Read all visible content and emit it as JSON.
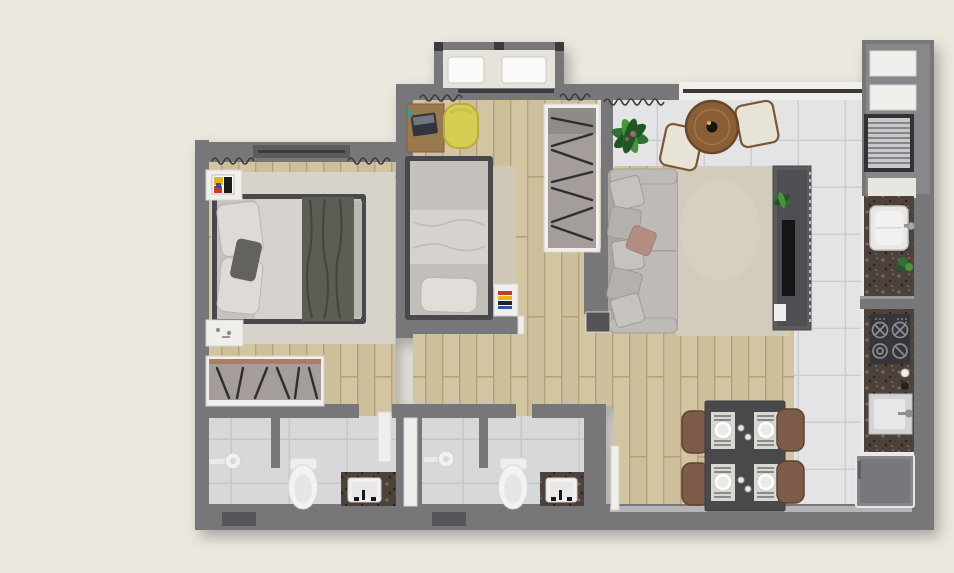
{
  "headline": {
    "lines": [
      "APARTAMENTOS",
      "PROJETADOS COM",
      "O PADRÃO DE",
      "QUALIDADE GIROLLAR."
    ]
  },
  "palette": {
    "background": "#ebe8df",
    "headline": "#3d4348",
    "wall": "#77777a",
    "wall_light": "#8e8e91",
    "wall_dark": "#3a3a3d",
    "wood": "#d3c4a2",
    "wood_dark": "#b3a179",
    "tile": "#e4e4e6",
    "tile_line": "#cdcdd0",
    "bath_tile": "#d8d8da",
    "bath_tile_line": "#c6c6c9",
    "granite": "#4d423a",
    "granite_fleck_light": "#7a6c5f",
    "granite_fleck_dark": "#29221c",
    "white_fixture": "#f3f2f0",
    "fixture_shadow": "#d6d5d3",
    "sofa": "#a9a6a3",
    "sofa_light": "#bdbab7",
    "cushion": "#c6c3bf",
    "cushion_rose": "#b18d82",
    "rug_living": "#d3cbbb",
    "rug_bedroom": "#d7d2ca",
    "bed_frame": "#4a4a4d",
    "bed_linen": "#c5c2be",
    "bed_duvet": "#d6d3cf",
    "blanket": "#5d5c55",
    "yellow_chair": "#d5ce52",
    "desk_wood": "#9b7950",
    "table_wood": "#8a5f38",
    "plant": "#2f7034",
    "plant_dark": "#245428",
    "plant_light": "#48943e",
    "dining_table": "#48484b",
    "dining_chair": "#7c5b4a",
    "fridge": "#85858a",
    "door_white": "#f1efeb",
    "door_dark": "#525257",
    "closet": "#a49d99",
    "slash": "#2f2f33",
    "accent_red": "#c23b2e",
    "accent_blue": "#2a57a5",
    "accent_yellow": "#e3b51f",
    "accent_teal": "#2f9e96"
  },
  "floor_plan": {
    "type": "apartment-floor-plan-top-view",
    "rooms": [
      {
        "name": "bedroom-1",
        "furniture": [
          "double-bed",
          "rug",
          "nightstand-with-artwork",
          "nightstand",
          "wardrobe-with-clothes",
          "window-with-curtains"
        ]
      },
      {
        "name": "bedroom-2",
        "furniture": [
          "single-bed",
          "desk-with-laptop",
          "yellow-chair",
          "rug",
          "nightstand-with-books",
          "sliding-wardrobe"
        ]
      },
      {
        "name": "hallway",
        "furniture": [
          "open-door"
        ]
      },
      {
        "name": "bathroom-1",
        "furniture": [
          "shower",
          "toilet",
          "vanity-sink",
          "door"
        ]
      },
      {
        "name": "bathroom-2",
        "furniture": [
          "shower",
          "toilet",
          "vanity-sink",
          "door"
        ]
      },
      {
        "name": "living-room",
        "furniture": [
          "sofa-with-cushions",
          "area-rug",
          "tv-panel",
          "potted-plant"
        ]
      },
      {
        "name": "balcony-terrace",
        "furniture": [
          "round-table",
          "two-chairs",
          "potted-plant",
          "glass-railing"
        ]
      },
      {
        "name": "dining-area",
        "furniture": [
          "table-for-four",
          "four-chairs",
          "place-settings"
        ]
      },
      {
        "name": "kitchen",
        "furniture": [
          "granite-countertop",
          "cooktop",
          "sink",
          "refrigerator"
        ]
      },
      {
        "name": "service-area",
        "furniture": [
          "laundry-tank",
          "louvered-window",
          "windows",
          "ac-units"
        ]
      }
    ]
  }
}
